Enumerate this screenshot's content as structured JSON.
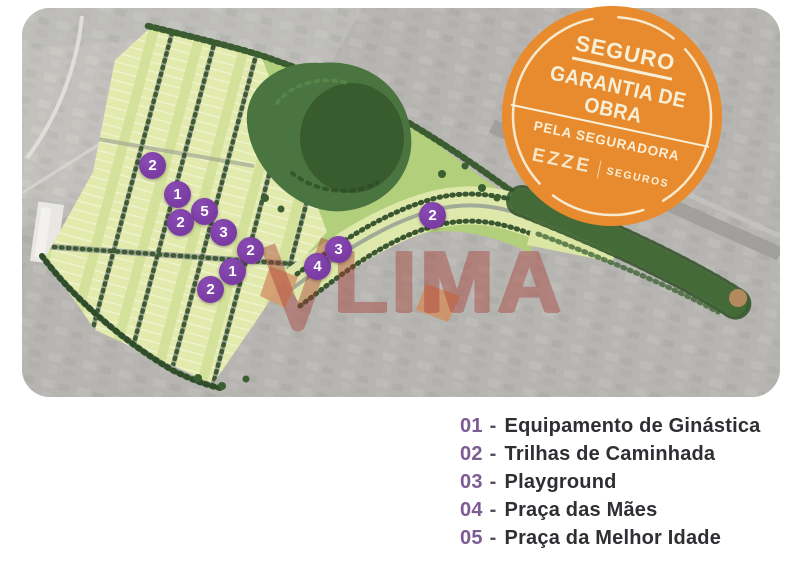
{
  "page": {
    "background": "#ffffff"
  },
  "badge": {
    "line1": "SEGURO",
    "line2": "GARANTIA DE OBRA",
    "line3": "PELA SEGURADORA",
    "brand": "EZZE",
    "brand_suffix": "SEGUROS",
    "bg_color": "#e88b2e",
    "text_color": "#f8efd7"
  },
  "watermark": {
    "text": "LIMA",
    "color": "#a83832"
  },
  "map": {
    "marker_color": "#7a3ba2",
    "markers": [
      {
        "label": "2",
        "x": 131,
        "y": 158
      },
      {
        "label": "1",
        "x": 156,
        "y": 187
      },
      {
        "label": "5",
        "x": 183,
        "y": 204
      },
      {
        "label": "2",
        "x": 159,
        "y": 215
      },
      {
        "label": "3",
        "x": 202,
        "y": 225
      },
      {
        "label": "2",
        "x": 229,
        "y": 243
      },
      {
        "label": "1",
        "x": 211,
        "y": 264
      },
      {
        "label": "2",
        "x": 189,
        "y": 282
      },
      {
        "label": "4",
        "x": 296,
        "y": 259
      },
      {
        "label": "3",
        "x": 317,
        "y": 242
      },
      {
        "label": "2",
        "x": 411,
        "y": 208
      }
    ]
  },
  "legend": {
    "separator": "-",
    "number_color": "#7d5c94",
    "items": [
      {
        "num": "01",
        "label": "Equipamento de Ginástica"
      },
      {
        "num": "02",
        "label": "Trilhas de Caminhada"
      },
      {
        "num": "03",
        "label": "Playground"
      },
      {
        "num": "04",
        "label": "Praça das Mães"
      },
      {
        "num": "05",
        "label": "Praça da Melhor Idade"
      }
    ]
  }
}
